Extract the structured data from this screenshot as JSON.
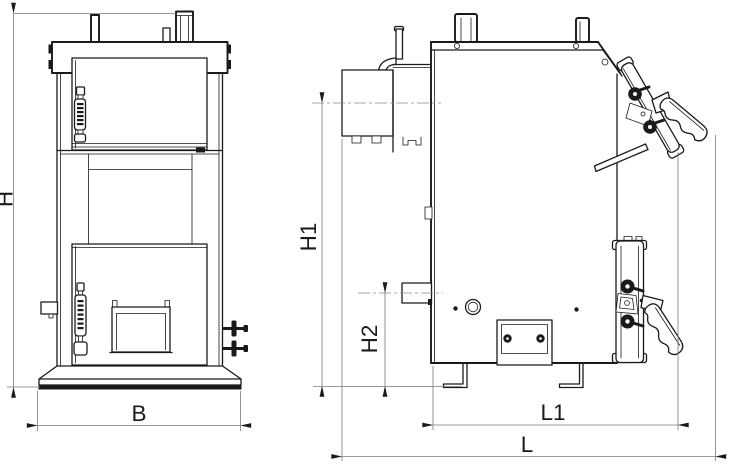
{
  "diagram": {
    "labels": {
      "H": "H",
      "B": "B",
      "H1": "H1",
      "H2": "H2",
      "L1": "L1",
      "L": "L"
    },
    "views": {
      "front": {
        "dimensions": [
          "H",
          "B"
        ]
      },
      "side": {
        "dimensions": [
          "H1",
          "H2",
          "L1",
          "L"
        ]
      }
    },
    "colors": {
      "part_line": "#1a1a1a",
      "dimension_line": "#7a7a7a",
      "background": "#ffffff"
    }
  }
}
